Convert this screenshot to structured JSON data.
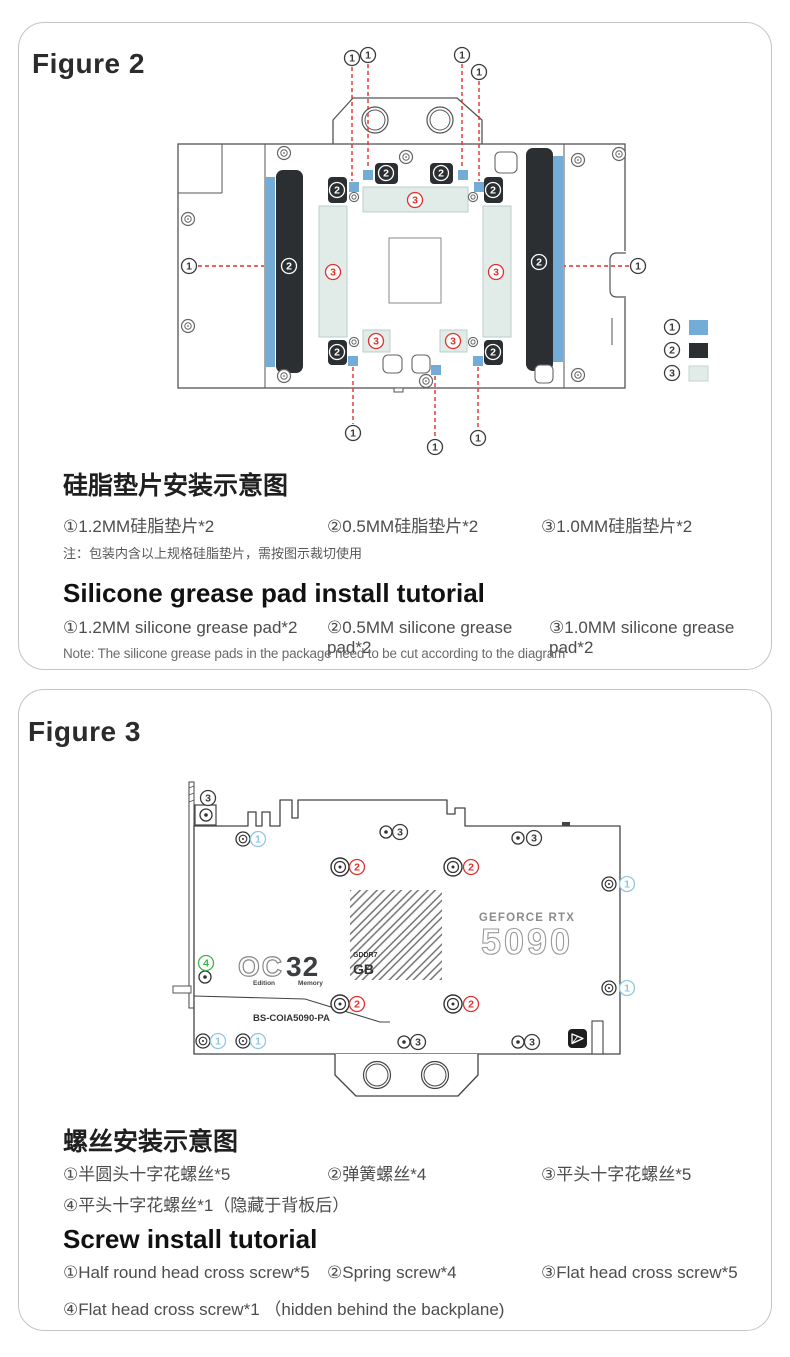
{
  "figure2": {
    "title": "Figure 2",
    "heading_zh": "硅脂垫片安装示意图",
    "items_zh": [
      "①1.2MM硅脂垫片*2",
      "②0.5MM硅脂垫片*2",
      "③1.0MM硅脂垫片*2"
    ],
    "note_zh": "注：包装内含以上规格硅脂垫片，需按图示裁切使用",
    "heading_en": "Silicone grease pad install tutorial",
    "items_en": [
      "①1.2MM silicone grease pad*2",
      "②0.5MM silicone grease pad*2",
      "③1.0MM silicone grease pad*2"
    ],
    "note_en": "Note: The silicone grease pads in the package need to be cut according to the diagram",
    "legend": [
      {
        "num": "1",
        "color": "#72acd7"
      },
      {
        "num": "2",
        "color": "#2b2f31"
      },
      {
        "num": "3",
        "color": "#e1ebe8"
      }
    ],
    "diagram_markers": [
      [
        352,
        58,
        "1",
        "k"
      ],
      [
        368,
        55,
        "1",
        "k"
      ],
      [
        462,
        55,
        "1",
        "k"
      ],
      [
        479,
        72,
        "1",
        "k"
      ],
      [
        189,
        266,
        "1",
        "k"
      ],
      [
        638,
        266,
        "1",
        "k"
      ],
      [
        353,
        433,
        "1",
        "k"
      ],
      [
        435,
        447,
        "1",
        "k"
      ],
      [
        478,
        438,
        "1",
        "k"
      ],
      [
        415,
        200,
        "3",
        "r"
      ],
      [
        333,
        272,
        "3",
        "r"
      ],
      [
        496,
        272,
        "3",
        "r"
      ],
      [
        376,
        341,
        "3",
        "r"
      ],
      [
        453,
        341,
        "3",
        "r"
      ],
      [
        289,
        266,
        "2",
        "w"
      ],
      [
        539,
        262,
        "2",
        "w"
      ],
      [
        386,
        173,
        "2",
        "w"
      ],
      [
        441,
        173,
        "2",
        "w"
      ],
      [
        337,
        190,
        "2",
        "w"
      ],
      [
        493,
        190,
        "2",
        "w"
      ],
      [
        337,
        352,
        "2",
        "w"
      ],
      [
        493,
        352,
        "2",
        "w"
      ],
      [
        672,
        327,
        "1",
        "k"
      ],
      [
        672,
        350,
        "2",
        "k"
      ],
      [
        672,
        373,
        "3",
        "k"
      ]
    ]
  },
  "figure3": {
    "title": "Figure 3",
    "gpu_brand": "GEFORCE RTX",
    "gpu_model": "5090",
    "logo_oc": "OC",
    "logo_32": "32",
    "logo_gddr": "GDDR7",
    "logo_gb": "GB",
    "logo_edition": "Edition",
    "logo_memory": "Memory",
    "board_code": "BS-COIA5090-PA",
    "heading_zh": "螺丝安装示意图",
    "items_zh": [
      "①半圆头十字花螺丝*5",
      "②弹簧螺丝*4",
      "③平头十字花螺丝*5"
    ],
    "item_zh_4": "④平头十字花螺丝*1（隐藏于背板后）",
    "heading_en": "Screw install tutorial",
    "items_en": [
      "①Half round head cross screw*5",
      "②Spring screw*4",
      "③Flat head cross screw*5"
    ],
    "item_en_4": "④Flat head cross screw*1 （hidden behind the backplane)",
    "diagram_markers": [
      [
        208,
        798,
        "3",
        "k"
      ],
      [
        400,
        832,
        "3",
        "k"
      ],
      [
        534,
        838,
        "3",
        "k"
      ],
      [
        418,
        1042,
        "3",
        "k"
      ],
      [
        532,
        1042,
        "3",
        "k"
      ],
      [
        258,
        839,
        "1",
        "b"
      ],
      [
        627,
        884,
        "1",
        "b"
      ],
      [
        627,
        988,
        "1",
        "b"
      ],
      [
        218,
        1041,
        "1",
        "b"
      ],
      [
        258,
        1041,
        "1",
        "b"
      ],
      [
        357,
        867,
        "2",
        "r"
      ],
      [
        471,
        867,
        "2",
        "r"
      ],
      [
        357,
        1004,
        "2",
        "r"
      ],
      [
        471,
        1004,
        "2",
        "r"
      ],
      [
        206,
        963,
        "4",
        "g"
      ]
    ]
  }
}
